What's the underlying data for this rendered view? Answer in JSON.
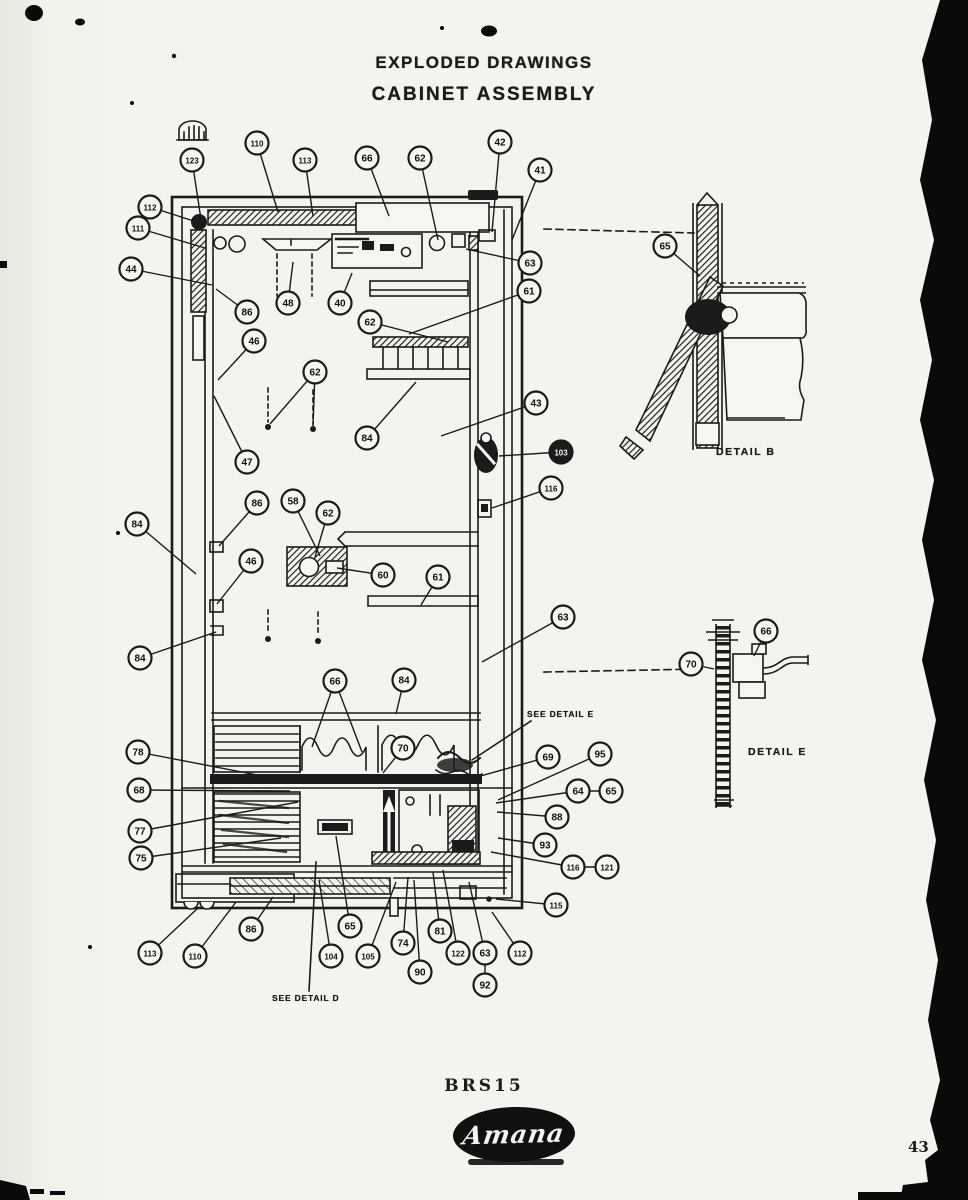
{
  "header": {
    "line1": "EXPLODED DRAWINGS",
    "line2": "CABINET ASSEMBLY"
  },
  "footer": {
    "model": "BRS15",
    "brand": "Amana",
    "page_number": "43"
  },
  "details": {
    "b_label": "DETAIL B",
    "e_label": "DETAIL E",
    "see_e": "SEE DETAIL E",
    "see_d": "SEE DETAIL D"
  },
  "colors": {
    "ink": "#1b1b1b",
    "paper": "#f4f3ed",
    "scan_edge": "#0a0a0a"
  },
  "callouts": [
    {
      "label": "123",
      "x": 192,
      "y": 160,
      "tx": 202,
      "ty": 226
    },
    {
      "label": "110",
      "x": 257,
      "y": 143,
      "tx": 278,
      "ty": 212
    },
    {
      "label": "113",
      "x": 305,
      "y": 160,
      "tx": 313,
      "ty": 216
    },
    {
      "label": "66",
      "x": 367,
      "y": 158,
      "tx": 389,
      "ty": 216
    },
    {
      "label": "62",
      "x": 420,
      "y": 158,
      "tx": 438,
      "ty": 240
    },
    {
      "label": "42",
      "x": 500,
      "y": 142,
      "tx": 492,
      "ty": 232
    },
    {
      "label": "41",
      "x": 540,
      "y": 170,
      "tx": 512,
      "ty": 240
    },
    {
      "label": "112",
      "x": 150,
      "y": 207,
      "tx": 200,
      "ty": 223
    },
    {
      "label": "111",
      "x": 138,
      "y": 228,
      "tx": 205,
      "ty": 248
    },
    {
      "label": "44",
      "x": 131,
      "y": 269,
      "tx": 212,
      "ty": 285
    },
    {
      "label": "86",
      "x": 247,
      "y": 312,
      "tx": 216,
      "ty": 289
    },
    {
      "label": "48",
      "x": 288,
      "y": 303,
      "tx": 293,
      "ty": 262
    },
    {
      "label": "40",
      "x": 340,
      "y": 303,
      "tx": 352,
      "ty": 273
    },
    {
      "label": "62",
      "x": 370,
      "y": 322,
      "tx": 448,
      "ty": 342
    },
    {
      "label": "46",
      "x": 254,
      "y": 341,
      "tx": 218,
      "ty": 380
    },
    {
      "label": "62",
      "x": 315,
      "y": 372,
      "tx": 270,
      "ty": 424,
      "tx2": 313,
      "ty2": 426
    },
    {
      "label": "47",
      "x": 247,
      "y": 462,
      "tx": 214,
      "ty": 396
    },
    {
      "label": "84",
      "x": 367,
      "y": 438,
      "tx": 416,
      "ty": 382
    },
    {
      "label": "63",
      "x": 530,
      "y": 263,
      "tx": 466,
      "ty": 249
    },
    {
      "label": "61",
      "x": 529,
      "y": 291,
      "tx": 409,
      "ty": 334
    },
    {
      "label": "43",
      "x": 536,
      "y": 403,
      "tx": 441,
      "ty": 436
    },
    {
      "label": "103",
      "x": 561,
      "y": 452,
      "dark": true,
      "tx": 499,
      "ty": 456
    },
    {
      "label": "116",
      "x": 551,
      "y": 488,
      "tx": 492,
      "ty": 508
    },
    {
      "label": "65",
      "x": 665,
      "y": 246,
      "tx": 700,
      "ty": 276
    },
    {
      "label": "84",
      "x": 137,
      "y": 524,
      "tx": 196,
      "ty": 574
    },
    {
      "label": "86",
      "x": 257,
      "y": 503,
      "tx": 219,
      "ty": 546
    },
    {
      "label": "58",
      "x": 293,
      "y": 501,
      "tx": 320,
      "ty": 556
    },
    {
      "label": "62",
      "x": 328,
      "y": 513,
      "tx": 315,
      "ty": 557
    },
    {
      "label": "60",
      "x": 383,
      "y": 575,
      "tx": 337,
      "ty": 568
    },
    {
      "label": "61",
      "x": 438,
      "y": 577,
      "tx": 421,
      "ty": 605
    },
    {
      "label": "46",
      "x": 251,
      "y": 561,
      "tx": 217,
      "ty": 604
    },
    {
      "label": "84",
      "x": 140,
      "y": 658,
      "tx": 216,
      "ty": 632
    },
    {
      "label": "63",
      "x": 563,
      "y": 617,
      "tx": 482,
      "ty": 662
    },
    {
      "label": "70",
      "x": 691,
      "y": 664,
      "tx": 714,
      "ty": 669
    },
    {
      "label": "66",
      "x": 766,
      "y": 631,
      "tx": 754,
      "ty": 656
    },
    {
      "label": "78",
      "x": 138,
      "y": 752,
      "tx": 283,
      "ty": 780
    },
    {
      "label": "68",
      "x": 139,
      "y": 790,
      "tx": 290,
      "ty": 791
    },
    {
      "label": "77",
      "x": 140,
      "y": 831,
      "tx": 298,
      "ty": 802
    },
    {
      "label": "75",
      "x": 141,
      "y": 858,
      "tx": 281,
      "ty": 838
    },
    {
      "label": "66",
      "x": 335,
      "y": 681,
      "tx": 312,
      "ty": 747,
      "tx2": 362,
      "ty2": 752
    },
    {
      "label": "84",
      "x": 404,
      "y": 680,
      "tx": 396,
      "ty": 714
    },
    {
      "label": "70",
      "x": 403,
      "y": 748,
      "tx": 383,
      "ty": 773
    },
    {
      "label": "69",
      "x": 548,
      "y": 757,
      "tx": 470,
      "ty": 779
    },
    {
      "label": "95",
      "x": 600,
      "y": 754,
      "tx": 498,
      "ty": 800
    },
    {
      "label": "64",
      "x": 578,
      "y": 791,
      "tx": 496,
      "ty": 803,
      "tx2": 600,
      "ty2": 791
    },
    {
      "label": "65",
      "x": 611,
      "y": 791
    },
    {
      "label": "88",
      "x": 557,
      "y": 817,
      "tx": 497,
      "ty": 812
    },
    {
      "label": "93",
      "x": 545,
      "y": 845,
      "tx": 498,
      "ty": 838
    },
    {
      "label": "116",
      "x": 573,
      "y": 867,
      "tx": 491,
      "ty": 852,
      "tx2": 596,
      "ty2": 867
    },
    {
      "label": "121",
      "x": 607,
      "y": 867
    },
    {
      "label": "115",
      "x": 556,
      "y": 905,
      "tx": 496,
      "ty": 899
    },
    {
      "label": "113",
      "x": 150,
      "y": 953,
      "tx": 198,
      "ty": 908
    },
    {
      "label": "110",
      "x": 195,
      "y": 956,
      "tx": 236,
      "ty": 902
    },
    {
      "label": "86",
      "x": 251,
      "y": 929,
      "tx": 273,
      "ty": 897
    },
    {
      "label": "65",
      "x": 350,
      "y": 926,
      "tx": 336,
      "ty": 836
    },
    {
      "label": "104",
      "x": 331,
      "y": 956,
      "tx": 319,
      "ty": 880
    },
    {
      "label": "105",
      "x": 368,
      "y": 956,
      "tx": 396,
      "ty": 882
    },
    {
      "label": "74",
      "x": 403,
      "y": 943,
      "tx": 408,
      "ty": 877
    },
    {
      "label": "90",
      "x": 420,
      "y": 972,
      "tx": 414,
      "ty": 880
    },
    {
      "label": "81",
      "x": 440,
      "y": 931,
      "tx": 433,
      "ty": 872
    },
    {
      "label": "122",
      "x": 458,
      "y": 953,
      "tx": 443,
      "ty": 870
    },
    {
      "label": "63",
      "x": 485,
      "y": 953,
      "tx": 469,
      "ty": 882
    },
    {
      "label": "92",
      "x": 485,
      "y": 985,
      "tx": 485,
      "ty": 964
    },
    {
      "label": "112",
      "x": 520,
      "y": 953,
      "tx": 492,
      "ty": 912
    }
  ]
}
